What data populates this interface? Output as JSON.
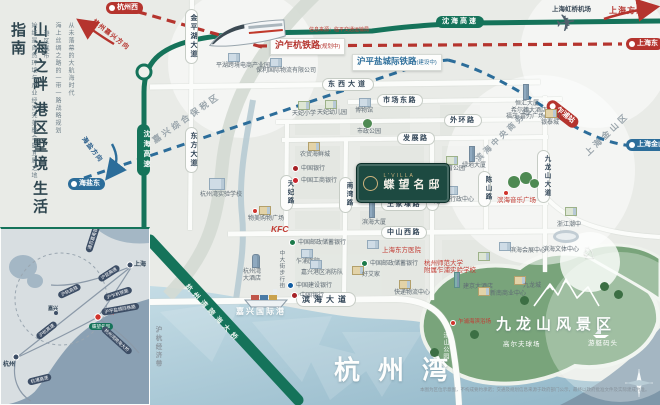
{
  "left_panel": {
    "title": "山海之畔 港区墅境 生活指南",
    "intro_col_1": "从未落幕的大航海时代",
    "intro_col_2": "海上丝绸之路的一带一路战略规划",
    "intro_col_3": "港区城市",
    "intro_col_4": "始终是自然环境与产业经济完美融合的宜居之地"
  },
  "railways": {
    "huzhahang": {
      "name": "沪乍杭铁路",
      "status": "(规划中)",
      "note": "信息来源：临平交通运输局",
      "color": "#b5342e"
    },
    "hupingyan": {
      "name": "沪平盐城际铁路",
      "status": "(建设中)",
      "color": "#2e6f9b"
    }
  },
  "stations": {
    "hangzhouxi": "杭州西",
    "haiyandong": "海盐东",
    "shanghaidong": "上海东",
    "zhapu": "乍浦站",
    "jinshanwei": "上海金山卫"
  },
  "directions": {
    "shanghai": "上海方向",
    "hangzhou_jiaxing": "杭州嘉兴方向",
    "haiyan": "海盐方向"
  },
  "highways": {
    "shenhai": "沈海高速",
    "bridge": "杭州湾跨海大桥"
  },
  "roads": {
    "jinpinghu": "金平湖大道",
    "dongfang": "东方大道",
    "dongxi": "东西大道",
    "shichang": "市场东路",
    "waihuan": "外环路",
    "fazhan": "发展路",
    "tianfei": "天妃路",
    "nanwan": "南湾路",
    "qixiang": "气象路",
    "wangjiadai": "王家埭路",
    "zhongshan": "中山西路",
    "binhai": "滨海大道",
    "chenshan": "陈山路",
    "jiulongshan": "九龙山大道"
  },
  "zones": {
    "baoshui": "嘉兴综合保税区",
    "cbd": "滨海中央商务区",
    "jinshan": "上海金山区",
    "economic_belt": "沪杭经济带"
  },
  "airport": "上海虹桥机场",
  "project": {
    "latin": "L'VILLA",
    "name": "蝶望名邸"
  },
  "landmarks": {
    "pinghu_ecommerce": "平湖跨境电商产业园",
    "baoli_logistics": "保利国际物流有限公司",
    "tianfei_primary": "天妃小学",
    "tianfei_kindergarten": "天妃幼儿园",
    "museum": "博物馆",
    "city_park": "市政公园",
    "hzw_school": "杭州湾实验学校",
    "wumei": "物美购物广场",
    "kfc": "KFC",
    "seafood_market": "农贸海鲜城",
    "bank_of_china": "中国银行",
    "icbc": "中国工商银行",
    "binhai_tower": "滨海大厦",
    "henghui_tower": "恒汇大厦",
    "hilton": "希尔顿大酒店",
    "fuli_plaza": "福茂·富力广场(在建)",
    "yintai": "银泰城",
    "sports_park": "体育公园",
    "greenland_tower": "绿地大厦",
    "music_square": "滨海音乐广场",
    "zhejiang_school": "浙江潮中",
    "culture_center": "滨海文体中心",
    "expo_center": "滨海会展中心",
    "admin_center": "港区行政中心",
    "shanghai_east_hospital": "上海东方医院",
    "psbc": "中国邮政储蓄银行",
    "hsd_school_l1": "杭州师范大学",
    "hsd_school_l2": "附属乍浦实验学校",
    "haoaijia": "好艾家",
    "logistics_center": "快递物流中心",
    "jianjing_hotel": "建京大酒店",
    "xinnan_center": "新南商业中心",
    "jiulongcheng": "九龙城",
    "zhapu_hospital": "乍浦医院",
    "fire_station": "嘉兴港区消防队",
    "ccb": "中国建设银行",
    "hzw_hotel_l1": "杭州湾",
    "hzw_hotel_l2": "大酒店",
    "walking_street": "中大街步行街",
    "tangshan_park": "汤山公园",
    "beach": "乍浦海滨浴场",
    "golf": "高尔夫球场",
    "yacht": "游艇码头"
  },
  "areas": {
    "bay": "杭州湾",
    "scenic": "九龙山风景区",
    "port": "嘉兴国际港"
  },
  "inset": {
    "cities": {
      "shanghai": "上海",
      "hangzhou": "杭州",
      "jiaxing": "嘉兴"
    },
    "marker_label": "本案",
    "marker_badge": "蝶望名邸",
    "capsules": [
      "沪杭高铁",
      "通苏嘉甬铁路",
      "沪昆高速",
      "沪乍杭铁路",
      "沪平盐城际铁路",
      "杭州湾跨海大桥",
      "杭浦高速",
      "沪杭高速"
    ]
  },
  "footer": {
    "disclaimer": "本图为区位示意图，不构成要约承诺；交通及规划信息来源于政府部门公示，最终以政府批准文件及实际建成为准。"
  }
}
